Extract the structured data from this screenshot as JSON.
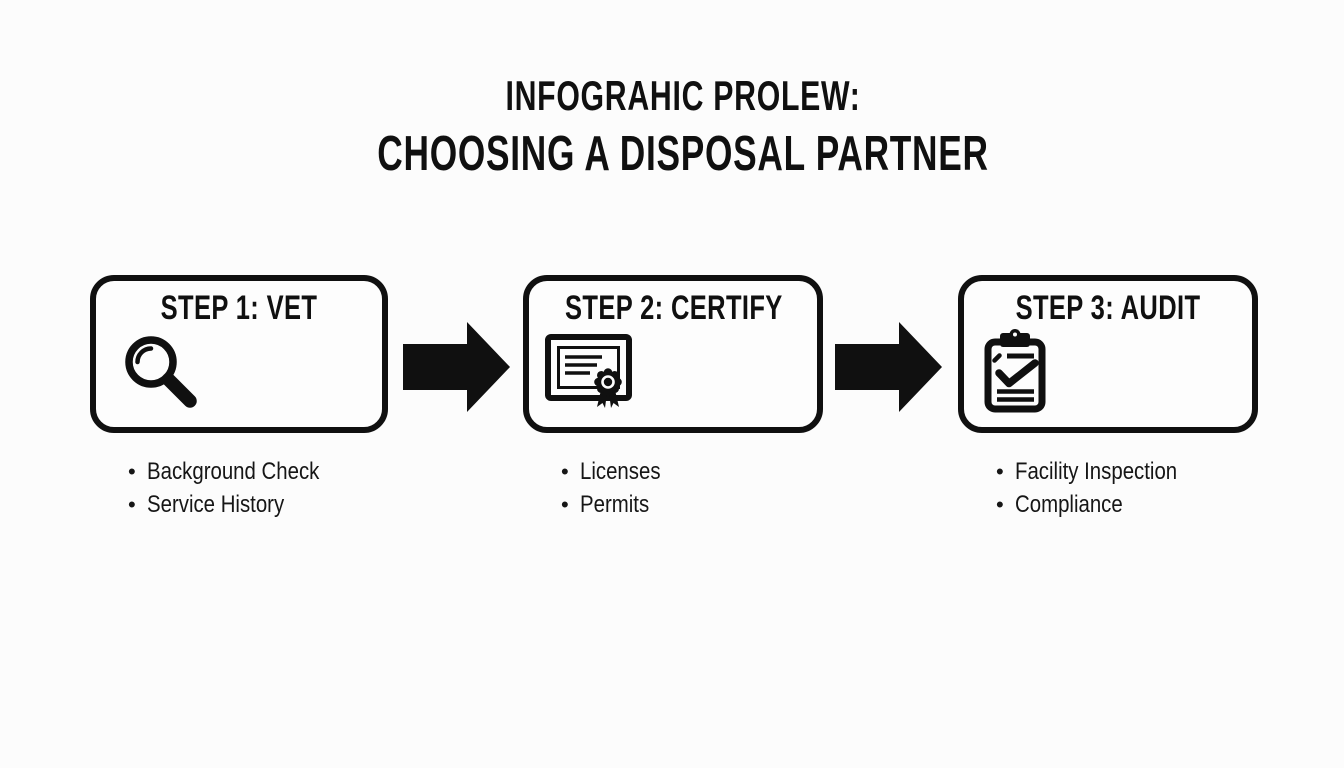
{
  "title": {
    "line1": "INFOGRAHIC PROLEW:",
    "line2": "CHOOSING A DISPOSAL PARTNER"
  },
  "steps": [
    {
      "label": "STEP 1: VET",
      "icon": "magnifier-search-icon",
      "bullets": [
        "Background Check",
        "Service History"
      ]
    },
    {
      "label": "STEP 2: CERTIFY",
      "icon": "certificate-ribbon-icon",
      "bullets": [
        "Licenses",
        "Permits"
      ]
    },
    {
      "label": "STEP 3: AUDIT",
      "icon": "clipboard-check-icon",
      "bullets": [
        "Facility Inspection",
        "Compliance"
      ]
    }
  ],
  "bullet_char": "•",
  "arrow_direction": "right",
  "colors": {
    "ink": "#101010",
    "background": "#fcfcfc"
  }
}
